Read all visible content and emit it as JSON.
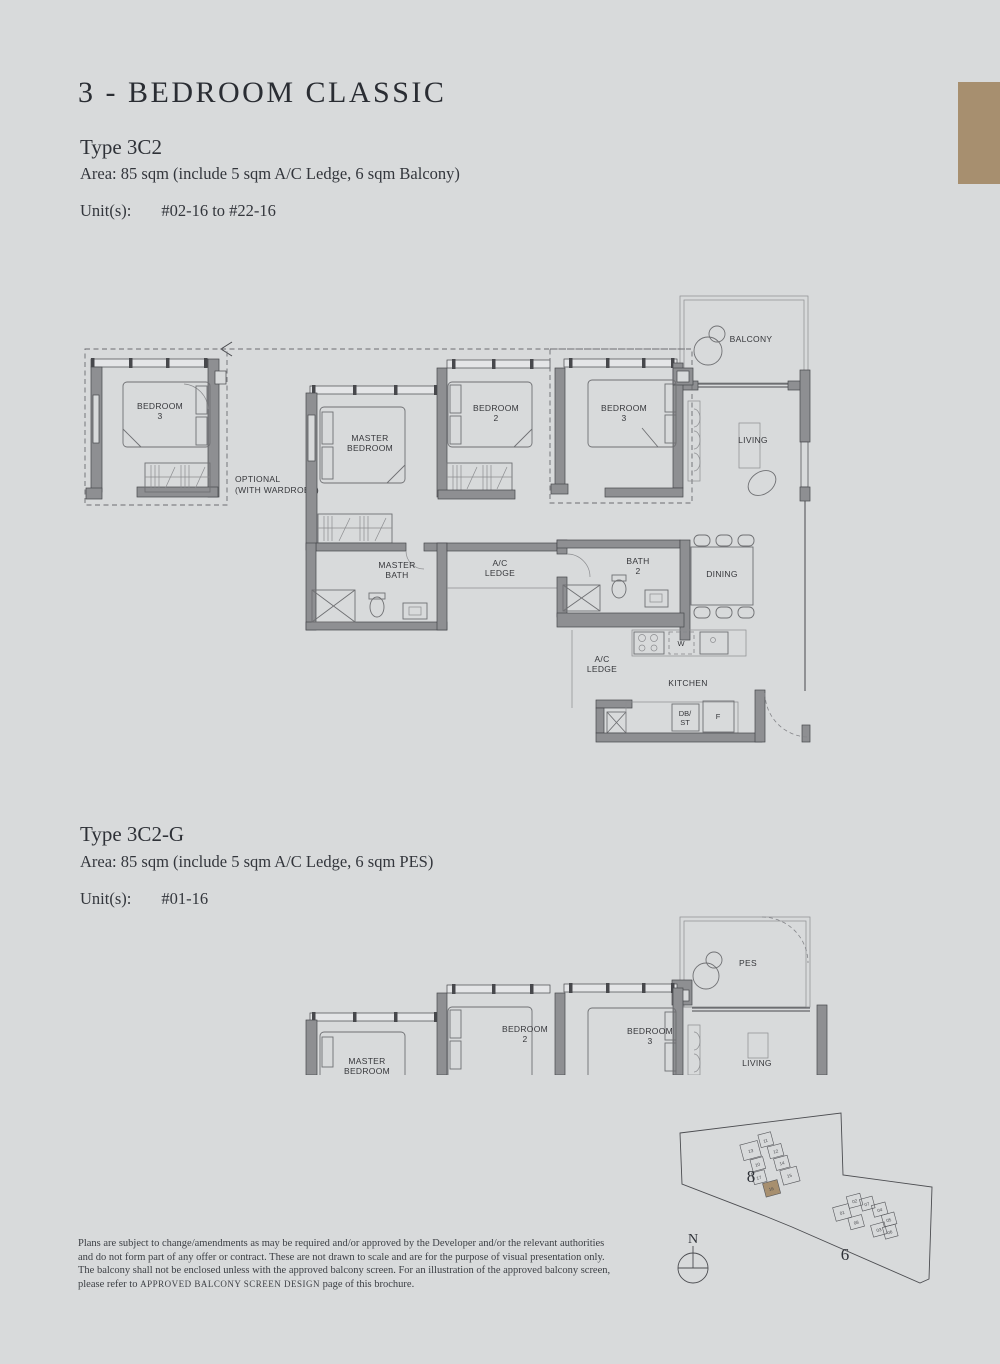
{
  "page": {
    "background": "#d8dadb",
    "accent_brown": "#a78f6f"
  },
  "header": {
    "title": "3 - BEDROOM CLASSIC"
  },
  "sections": [
    {
      "type_label": "Type 3C2",
      "area": "Area: 85 sqm (include 5 sqm A/C Ledge, 6 sqm Balcony)",
      "units_label": "Unit(s):",
      "units_value": "#02-16 to #22-16"
    },
    {
      "type_label": "Type 3C2-G",
      "area": "Area: 85 sqm (include 5 sqm A/C Ledge, 6 sqm PES)",
      "units_label": "Unit(s):",
      "units_value": "#01-16"
    }
  ],
  "plan1": {
    "optional_line1": "OPTIONAL",
    "optional_line2": "(WITH WARDROBE)",
    "bedroom3_opt_1": "BEDROOM",
    "bedroom3_opt_2": "3",
    "master_1": "MASTER",
    "master_2": "BEDROOM",
    "bedroom2_1": "BEDROOM",
    "bedroom2_2": "2",
    "bedroom3_1": "BEDROOM",
    "bedroom3_2": "3",
    "balcony": "BALCONY",
    "living": "LIVING",
    "master_bath_1": "MASTER",
    "master_bath_2": "BATH",
    "ac_ledge_1": "A/C",
    "ac_ledge_2": "LEDGE",
    "bath2_1": "BATH",
    "bath2_2": "2",
    "dining": "DINING",
    "ac_ledge2_1": "A/C",
    "ac_ledge2_2": "LEDGE",
    "kitchen": "KITCHEN",
    "washer": "W",
    "db": "DB/",
    "st": "ST",
    "fridge": "F"
  },
  "plan2": {
    "pes": "PES",
    "master_1": "MASTER",
    "master_2": "BEDROOM",
    "bedroom2_1": "BEDROOM",
    "bedroom2_2": "2",
    "bedroom3_1": "BEDROOM",
    "bedroom3_2": "3",
    "living": "LIVING"
  },
  "site_plan": {
    "block8": "8",
    "block6": "6",
    "north": "N",
    "block8_units": [
      "13",
      "11",
      "12",
      "10",
      "17",
      "14",
      "15",
      "16"
    ],
    "block6_units": [
      "02",
      "01",
      "07",
      "04",
      "08",
      "05",
      "03",
      "06"
    ],
    "highlighted_unit": "16"
  },
  "disclaimer": {
    "line1": "Plans are subject to change/amendments as may be required and/or approved by the Developer and/or the relevant authorities",
    "line2": "and do not form part of any offer or contract. These are not drawn to scale and are for the purpose of visual presentation only.",
    "line3": "The balcony shall not be enclosed unless with the approved balcony screen. For an illustration of the approved balcony screen,",
    "line4_prefix": "please refer to ",
    "line4_smallcaps": "APPROVED BALCONY SCREEN DESIGN",
    "line4_suffix": " page of this brochure."
  }
}
